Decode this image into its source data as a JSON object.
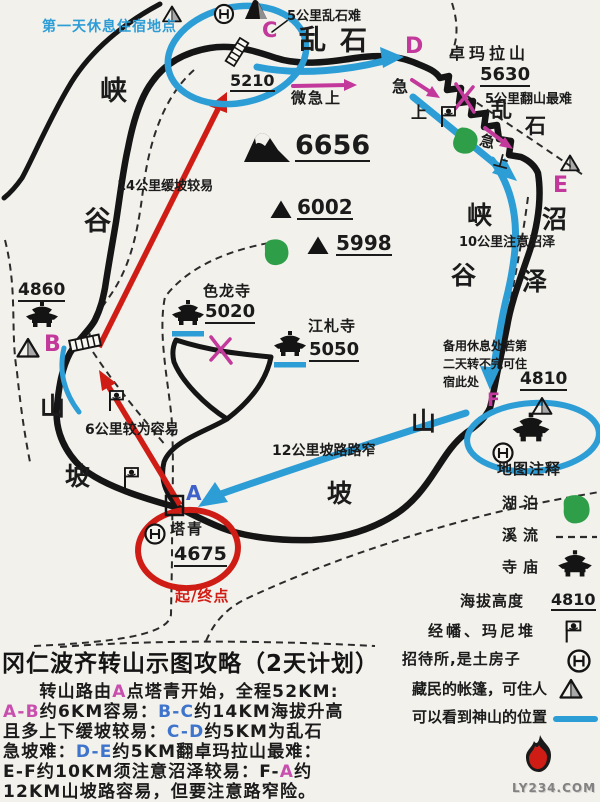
{
  "colors": {
    "ink": "#1b1b1b",
    "blue": "#2d9dd6",
    "pink": "#c2399b",
    "red": "#cf1d15",
    "green": "#2e9e48",
    "letter_blue": "#3f62c8",
    "para_pink": "#c84fae",
    "para_blue": "#3e74cc",
    "grey": "#a9a9a9"
  },
  "map": {
    "texts": [
      {
        "t": "第一天休息住宿地点",
        "x": 42,
        "y": 20,
        "s": 14,
        "c": "blue",
        "b": 1,
        "ls": 1
      },
      {
        "t": "5公里乱石难",
        "x": 287,
        "y": 10,
        "s": 13,
        "b": 1
      },
      {
        "t": "C",
        "x": 262,
        "y": 20,
        "s": 21,
        "c": "pink",
        "b": 1
      },
      {
        "t": "乱",
        "x": 299,
        "y": 27,
        "s": 27,
        "b": 1
      },
      {
        "t": "石",
        "x": 340,
        "y": 28,
        "s": 27,
        "b": 1
      },
      {
        "t": "D",
        "x": 405,
        "y": 36,
        "s": 22,
        "c": "pink",
        "b": 1
      },
      {
        "t": "卓玛拉山",
        "x": 449,
        "y": 46,
        "s": 16,
        "b": 1,
        "ls": 4
      },
      {
        "t": "5630",
        "x": 480,
        "y": 66,
        "s": 18,
        "b": 1,
        "u": 1
      },
      {
        "t": "5公里翻山最难",
        "x": 485,
        "y": 93,
        "s": 13,
        "b": 1
      },
      {
        "t": "5210",
        "x": 230,
        "y": 73,
        "s": 16,
        "b": 1,
        "u": 1
      },
      {
        "t": "微急上",
        "x": 291,
        "y": 91,
        "s": 15,
        "b": 1,
        "ls": 2
      },
      {
        "t": "急",
        "x": 392,
        "y": 79,
        "s": 16,
        "b": 1
      },
      {
        "t": "上",
        "x": 411,
        "y": 105,
        "s": 16,
        "b": 1
      },
      {
        "t": "乱",
        "x": 491,
        "y": 100,
        "s": 21,
        "b": 1
      },
      {
        "t": "石",
        "x": 525,
        "y": 116,
        "s": 21,
        "b": 1
      },
      {
        "t": "急",
        "x": 482,
        "y": 133,
        "s": 15,
        "b": 1,
        "r": 15
      },
      {
        "t": "上",
        "x": 496,
        "y": 153,
        "s": 15,
        "b": 1,
        "r": 15
      },
      {
        "t": "E",
        "x": 553,
        "y": 175,
        "s": 22,
        "c": "pink",
        "b": 1
      },
      {
        "t": "峡",
        "x": 100,
        "y": 78,
        "s": 27,
        "b": 1
      },
      {
        "t": "谷",
        "x": 84,
        "y": 208,
        "s": 27,
        "b": 1
      },
      {
        "t": "6656",
        "x": 295,
        "y": 132,
        "s": 27,
        "b": 1,
        "u": 1
      },
      {
        "t": "6002",
        "x": 297,
        "y": 197,
        "s": 20,
        "b": 1,
        "u": 1
      },
      {
        "t": "5998",
        "x": 336,
        "y": 233,
        "s": 20,
        "b": 1,
        "u": 1
      },
      {
        "t": "14公里缓坡较易",
        "x": 117,
        "y": 180,
        "s": 13,
        "b": 1
      },
      {
        "t": "色龙寺",
        "x": 203,
        "y": 284,
        "s": 15,
        "b": 1,
        "ls": 1
      },
      {
        "t": "5020",
        "x": 205,
        "y": 303,
        "s": 18,
        "b": 1,
        "u": 1
      },
      {
        "t": "江札寺",
        "x": 308,
        "y": 319,
        "s": 15,
        "b": 1,
        "ls": 1
      },
      {
        "t": "5050",
        "x": 309,
        "y": 341,
        "s": 18,
        "b": 1,
        "u": 1
      },
      {
        "t": "4860",
        "x": 18,
        "y": 282,
        "s": 17,
        "b": 1,
        "u": 1
      },
      {
        "t": "B",
        "x": 44,
        "y": 334,
        "s": 22,
        "c": "pink",
        "b": 1
      },
      {
        "t": "峡",
        "x": 467,
        "y": 203,
        "s": 25,
        "b": 1
      },
      {
        "t": "谷",
        "x": 451,
        "y": 263,
        "s": 25,
        "b": 1
      },
      {
        "t": "沼",
        "x": 542,
        "y": 207,
        "s": 25,
        "b": 1
      },
      {
        "t": "泽",
        "x": 522,
        "y": 269,
        "s": 25,
        "b": 1
      },
      {
        "t": "10公里注意沼泽",
        "x": 459,
        "y": 236,
        "s": 13,
        "b": 1
      },
      {
        "t": "备用休息处若第",
        "x": 443,
        "y": 340,
        "s": 12,
        "b": 1
      },
      {
        "t": "二天转不完可住",
        "x": 443,
        "y": 358,
        "s": 12,
        "b": 1
      },
      {
        "t": "宿此处",
        "x": 443,
        "y": 376,
        "s": 12,
        "b": 1
      },
      {
        "t": "4810",
        "x": 520,
        "y": 371,
        "s": 17,
        "b": 1,
        "u": 1
      },
      {
        "t": "F",
        "x": 487,
        "y": 391,
        "s": 19,
        "c": "pink",
        "b": 1
      },
      {
        "t": "山",
        "x": 40,
        "y": 394,
        "s": 25,
        "b": 1
      },
      {
        "t": "坡",
        "x": 65,
        "y": 464,
        "s": 25,
        "b": 1
      },
      {
        "t": "6公里较为容易",
        "x": 85,
        "y": 423,
        "s": 14,
        "b": 1
      },
      {
        "t": "山",
        "x": 411,
        "y": 409,
        "s": 25,
        "b": 1
      },
      {
        "t": "坡",
        "x": 327,
        "y": 481,
        "s": 25,
        "b": 1
      },
      {
        "t": "12公里坡路路窄",
        "x": 272,
        "y": 444,
        "s": 14,
        "b": 1
      },
      {
        "t": "A",
        "x": 186,
        "y": 483,
        "s": 20,
        "c": "letter_blue",
        "b": 1
      },
      {
        "t": "塔青",
        "x": 170,
        "y": 522,
        "s": 15,
        "b": 1,
        "ls": 2
      },
      {
        "t": "4675",
        "x": 174,
        "y": 545,
        "s": 19,
        "b": 1,
        "u": 1
      },
      {
        "t": "起/终点",
        "x": 175,
        "y": 589,
        "s": 15,
        "c": "red",
        "b": 1,
        "ls": 1
      }
    ]
  },
  "legend": {
    "title": "地图注释",
    "title_x": 497,
    "title_y": 462,
    "items": [
      {
        "label": "湖泊",
        "x": 502,
        "y": 496,
        "ls": 6
      },
      {
        "label": "溪流",
        "x": 502,
        "y": 528,
        "ls": 6
      },
      {
        "label": "寺庙",
        "x": 502,
        "y": 560,
        "ls": 6
      },
      {
        "label": "海拔高度",
        "x": 460,
        "y": 594,
        "ls": 1,
        "value": "4810",
        "vx": 551,
        "vy": 592
      },
      {
        "label": "经幡、玛尼堆",
        "x": 428,
        "y": 624,
        "ls": 3
      },
      {
        "label": "招待所,是土房子",
        "x": 402,
        "y": 652,
        "ls": 1
      },
      {
        "label": "藏民的帐篷，可住人",
        "x": 412,
        "y": 682,
        "ls": 0
      },
      {
        "label": "可以看到神山的位置",
        "x": 412,
        "y": 710,
        "ls": 0
      }
    ]
  },
  "footer": {
    "title": "冈仁波齐转山示图攻略（2天计划）",
    "lines": [
      [
        {
          "t": "　　转山路由",
          "c": "ink"
        },
        {
          "t": "A",
          "c": "para_pink"
        },
        {
          "t": "点塔青开始，全程52KM:",
          "c": "ink"
        }
      ],
      [
        {
          "t": "A-B",
          "c": "para_pink"
        },
        {
          "t": "约6KM容易：",
          "c": "ink"
        },
        {
          "t": "B-C",
          "c": "para_blue"
        },
        {
          "t": "约14KM海拔升高",
          "c": "ink"
        }
      ],
      [
        {
          "t": "且多上下缓坡较易：",
          "c": "ink"
        },
        {
          "t": "C-D",
          "c": "para_blue"
        },
        {
          "t": "约5KM为乱石",
          "c": "ink"
        }
      ],
      [
        {
          "t": "急坡难：",
          "c": "ink"
        },
        {
          "t": "D-E",
          "c": "para_blue"
        },
        {
          "t": "约5KM翻卓玛拉山最难：",
          "c": "ink"
        }
      ],
      [
        {
          "t": "E-F",
          "c": "ink"
        },
        {
          "t": "约10KM须注意沼泽较易：",
          "c": "ink"
        },
        {
          "t": "F-",
          "c": "ink"
        },
        {
          "t": "A",
          "c": "para_pink"
        },
        {
          "t": "约",
          "c": "ink"
        }
      ],
      [
        {
          "t": "12KM山坡路容易，但要注意路窄险。",
          "c": "ink"
        }
      ]
    ]
  },
  "watermark": "LY234.COM"
}
